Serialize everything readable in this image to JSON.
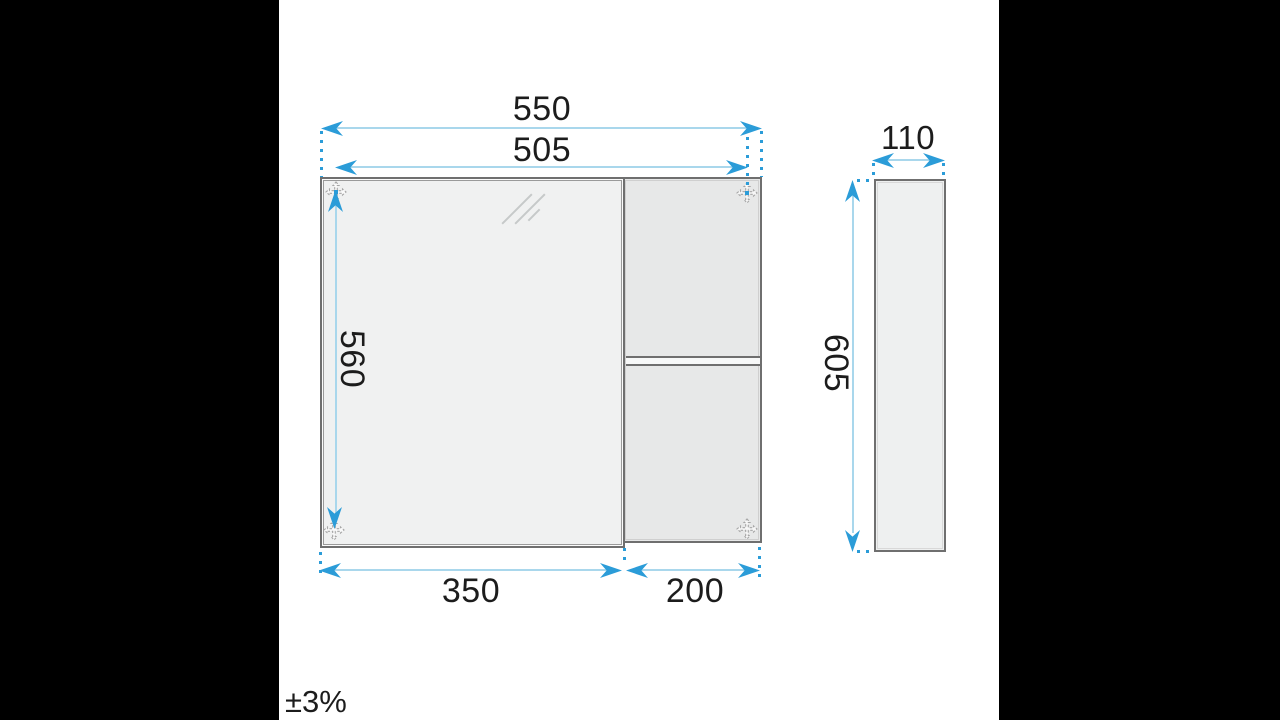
{
  "title": "Bathroom wall cabinet dimension drawing",
  "front_view": {
    "total_width": "550",
    "mounting_width": "505",
    "mounting_height": "560",
    "door_width": "350",
    "shelf_width": "200"
  },
  "side_view": {
    "depth": "110",
    "height": "605"
  },
  "tolerance": {
    "label": "±3%"
  },
  "colors": {
    "dimension_accent": "#2b9cd8",
    "dimension_line": "#a9d7ec",
    "cabinet_outline": "#6f6f6f",
    "mirror_fill": "#f0f1f1",
    "body_fill": "#e7e8e8",
    "background": "#000000",
    "panel": "#ffffff",
    "text": "#1c1c1c"
  },
  "icons": {
    "mounting_point": "four-way-arrow",
    "dimension_arrow": "triangle-arrow"
  }
}
